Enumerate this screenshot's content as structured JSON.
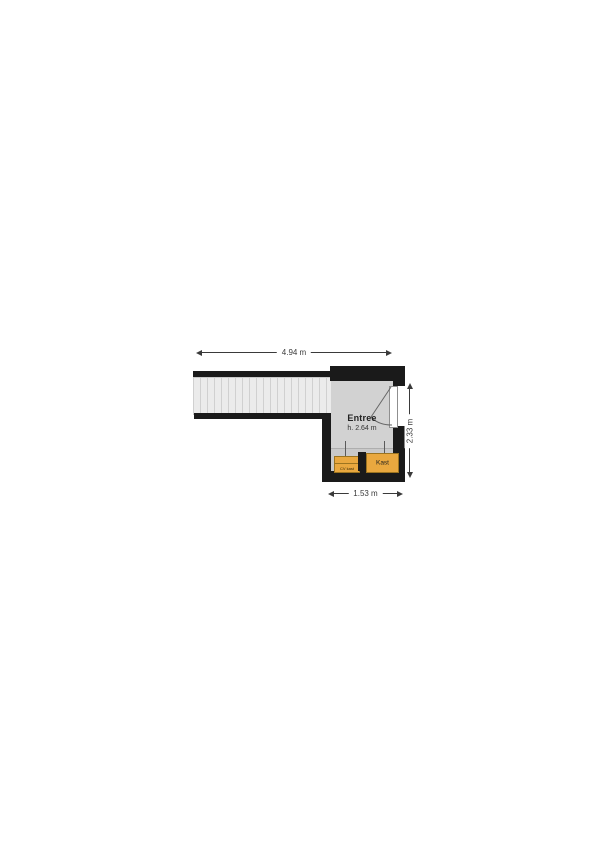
{
  "floorplan": {
    "room": {
      "name": "Entree",
      "ceiling_height": "h. 2.64 m"
    },
    "dimensions": {
      "width_top": "4.94 m",
      "height_right": "2.33 m",
      "width_bottom": "1.53 m"
    },
    "closets": {
      "kast": "Kast",
      "cv": "CV kast"
    },
    "icons": {
      "door": "door-swing-icon"
    },
    "colors": {
      "wall": "#1a1a1a",
      "room-fill": "#d2d2d2",
      "stairs-fill": "#ebebeb",
      "stairs-line": "#d0d0d0",
      "band-fill": "#c9c9c9",
      "closet-fill": "#e9a83f",
      "closet-border": "#9c7420",
      "dim": "#3a3a3a",
      "text": "#232323"
    }
  }
}
